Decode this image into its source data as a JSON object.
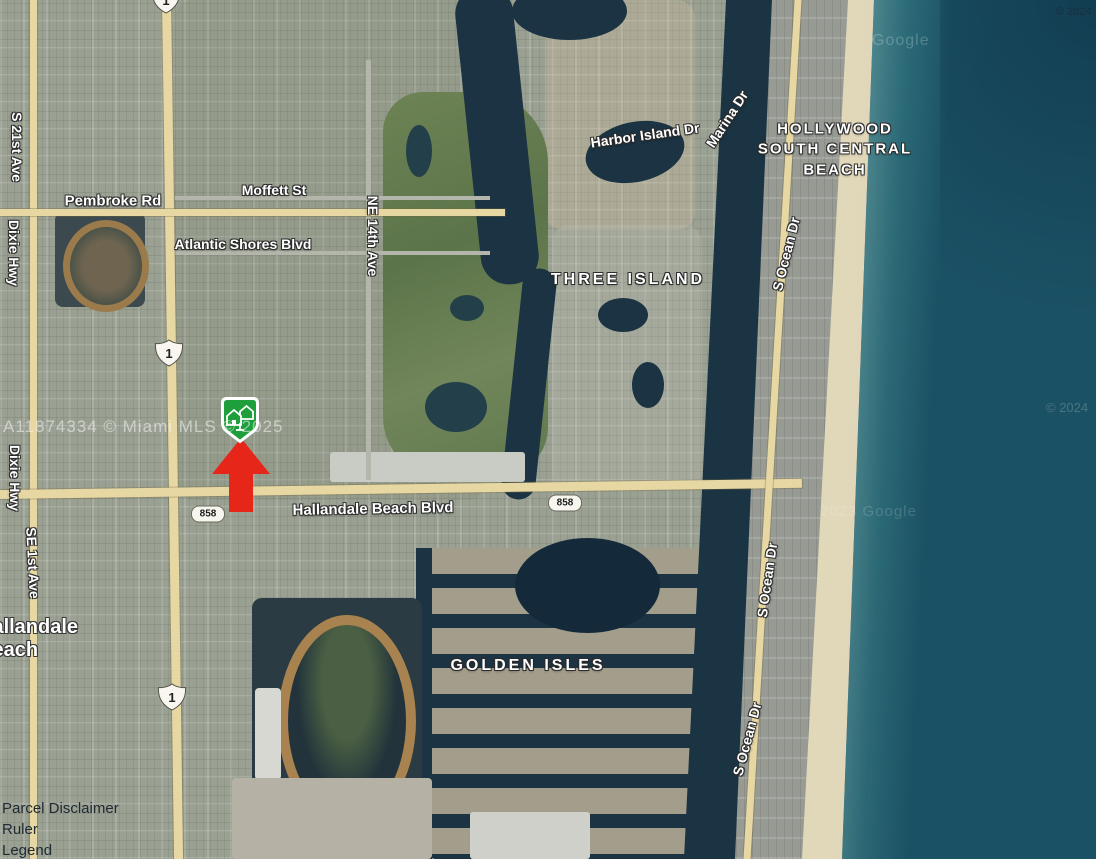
{
  "map": {
    "labels": {
      "s21st_ave": "S 21st Ave",
      "dixie_hwy": "Dixie Hwy",
      "se1st_ave": "SE 1st Ave",
      "pembroke_rd": "Pembroke Rd",
      "moffett_st": "Moffett St",
      "atlantic_shores_blvd": "Atlantic Shores Blvd",
      "ne_14th_ave": "NE 14th Ave",
      "harbor_island_dr": "Harbor Island Dr",
      "marina_dr": "Marina Dr",
      "hollywood_south_central_beach": {
        "line1": "HOLLYWOOD",
        "line2": "SOUTH CENTRAL",
        "line3": "BEACH"
      },
      "three_island": "THREE ISLAND",
      "golden_isles": "GOLDEN ISLES",
      "s_ocean_dr": "S Ocean Dr",
      "hallandale_beach_blvd": "Hallandale Beach Blvd",
      "city": {
        "line1": "Hallandale",
        "line2": "Beach"
      }
    },
    "shields": {
      "us_route_1": "1",
      "state_road_858": "858"
    },
    "watermarks": {
      "mls": "A11874334 © Miami MLS © 2025",
      "google": "Google",
      "tile_credit": "2023 Google",
      "tile_year": "© 2024",
      "corner_credit": "© 2024"
    },
    "controls": {
      "parcel_disclaimer": "Parcel Disclaimer",
      "ruler": "Ruler",
      "legend": "Legend"
    },
    "marker": {
      "pin_color": "#1f9e3c",
      "arrow_color": "#e7261a"
    }
  }
}
